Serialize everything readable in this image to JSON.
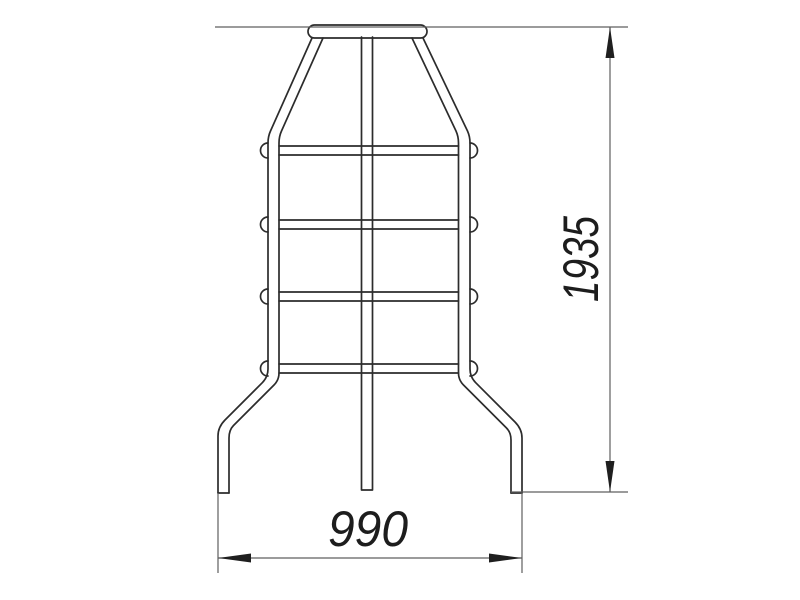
{
  "drawing": {
    "labels": {
      "height_mm": "1935",
      "width_mm": "990"
    },
    "colors": {
      "background": "#ffffff",
      "structure_line": "#2c2c2c",
      "dimension_line": "#5f5f5f",
      "arrow_fill": "#1f1f1f",
      "text": "#1d1d1d"
    }
  }
}
